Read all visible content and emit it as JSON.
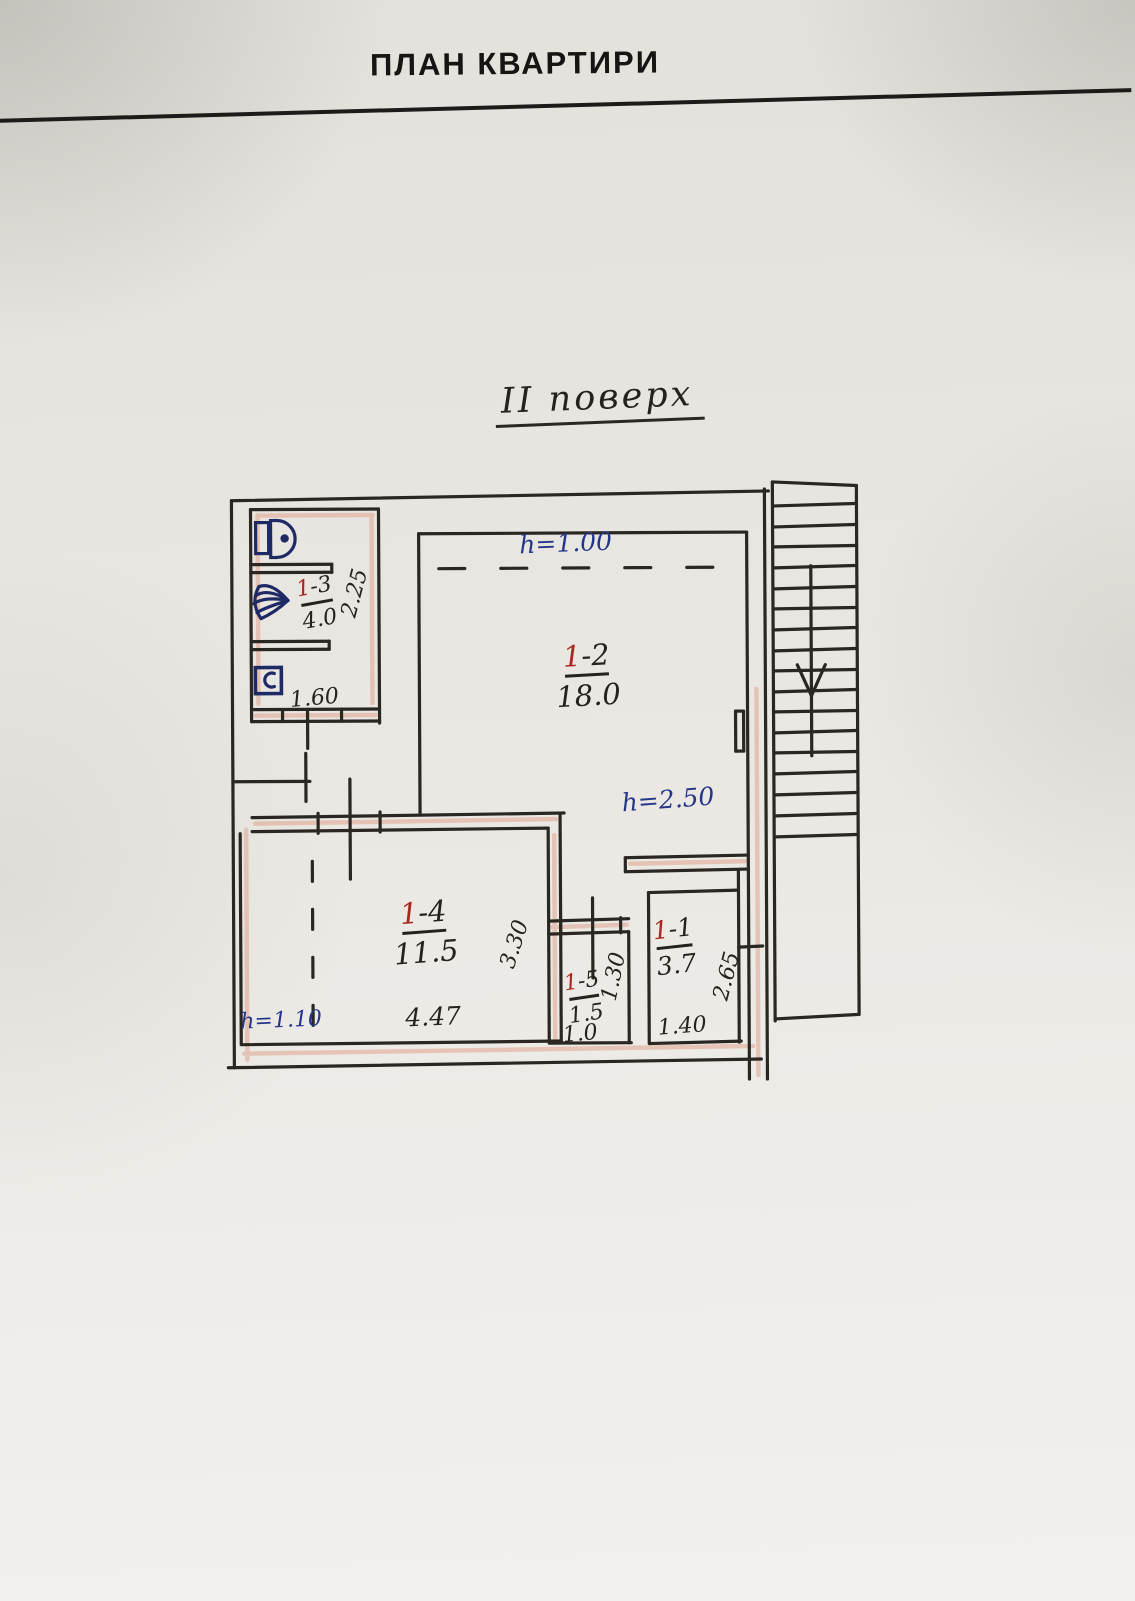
{
  "page": {
    "title": "ПЛАН КВАРТИРИ",
    "floor_label": "ІІ поверх"
  },
  "rooms": [
    {
      "id_prefix": "1",
      "id_suffix": "-3",
      "area": "4.0"
    },
    {
      "id_prefix": "1",
      "id_suffix": "-2",
      "area": "18.0"
    },
    {
      "id_prefix": "1",
      "id_suffix": "-4",
      "area": "11.5"
    },
    {
      "id_prefix": "1",
      "id_suffix": "-5",
      "area": "1.5"
    },
    {
      "id_prefix": "1",
      "id_suffix": "-1",
      "area": "3.7"
    }
  ],
  "heights": {
    "room_1_2": "h=1.00",
    "hall": "h=2.50",
    "room_1_4": "h=1.10"
  },
  "dimensions": {
    "bathroom_depth": "2.25",
    "bathroom_width": "1.60",
    "room_1_4_width": "4.47",
    "room_1_4_depth": "3.30",
    "room_1_5_width": "1.0",
    "room_1_5_depth": "1.30",
    "room_1_1_width": "1.40",
    "room_1_1_depth": "2.65"
  },
  "colors": {
    "ink_black": "#26231f",
    "ink_blue": "#23368a",
    "ink_red": "#a8271e",
    "wall_highlight": "#e0ab97",
    "paper": "#e9e6e1"
  }
}
